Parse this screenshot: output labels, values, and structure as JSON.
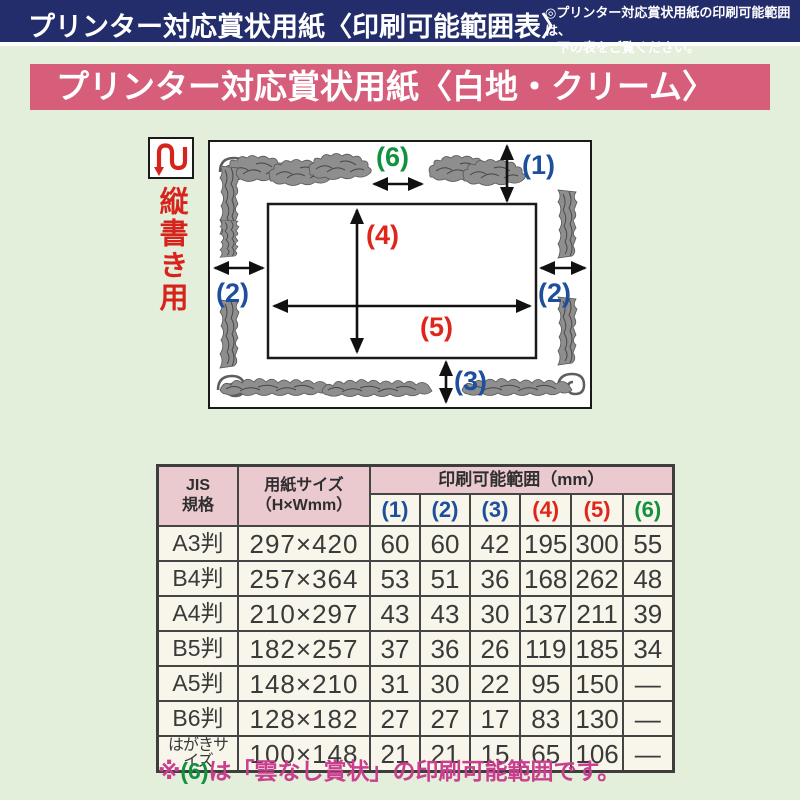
{
  "top_bar": {
    "title": "プリンター対応賞状用紙〈印刷可能範囲表〉",
    "note_line1": "◎プリンター対応賞状用紙の印刷可能範囲は、",
    "note_line2": "下の表をご覧ください。"
  },
  "banner": {
    "title": "プリンター対応賞状用紙〈白地・クリーム〉"
  },
  "diagram": {
    "orientation_label": "縦書き用",
    "measure_labels": {
      "m1": "(1)",
      "m2": "(2)",
      "m3": "(3)",
      "m4": "(4)",
      "m5": "(5)",
      "m6": "(6)"
    }
  },
  "table": {
    "header": {
      "jis_line1": "JIS",
      "jis_line2": "規格",
      "size_line1": "用紙サイズ",
      "size_line2": "（H×Wmm）",
      "range_title": "印刷可能範囲（mm）",
      "cols": [
        "(1)",
        "(2)",
        "(3)",
        "(4)",
        "(5)",
        "(6)"
      ],
      "col_colors": [
        "#1e4f9c",
        "#1e4f9c",
        "#1e4f9c",
        "#e0251b",
        "#e0251b",
        "#12913f"
      ]
    },
    "rows": [
      {
        "jis": "A3判",
        "size": "297×420",
        "values": [
          "60",
          "60",
          "42",
          "195",
          "300",
          "55"
        ]
      },
      {
        "jis": "B4判",
        "size": "257×364",
        "values": [
          "53",
          "51",
          "36",
          "168",
          "262",
          "48"
        ]
      },
      {
        "jis": "A4判",
        "size": "210×297",
        "values": [
          "43",
          "43",
          "30",
          "137",
          "211",
          "39"
        ]
      },
      {
        "jis": "B5判",
        "size": "182×257",
        "values": [
          "37",
          "36",
          "26",
          "119",
          "185",
          "34"
        ]
      },
      {
        "jis": "A5判",
        "size": "148×210",
        "values": [
          "31",
          "30",
          "22",
          "95",
          "150",
          "—"
        ]
      },
      {
        "jis": "B6判",
        "size": "128×182",
        "values": [
          "27",
          "27",
          "17",
          "83",
          "130",
          "—"
        ]
      },
      {
        "jis": "はがきサイズ",
        "size": "100×148",
        "values": [
          "21",
          "21",
          "15",
          "65",
          "106",
          "—"
        ]
      }
    ]
  },
  "footnote": {
    "mark": "※",
    "ref": "(6)",
    "text": "は「雲なし賞状」の印刷可能範囲です。"
  },
  "colors": {
    "navy_bar": "#232d6b",
    "page_background": "#e3eedb",
    "banner_pink": "#d65e7b",
    "table_header_pink": "#eac9cf",
    "table_body_cream": "#f8f5eb",
    "label_blue": "#1e4f9c",
    "label_red": "#e0251b",
    "label_green": "#12913f",
    "footnote_magenta": "#c93f8e",
    "orientation_red": "#d6231c"
  }
}
